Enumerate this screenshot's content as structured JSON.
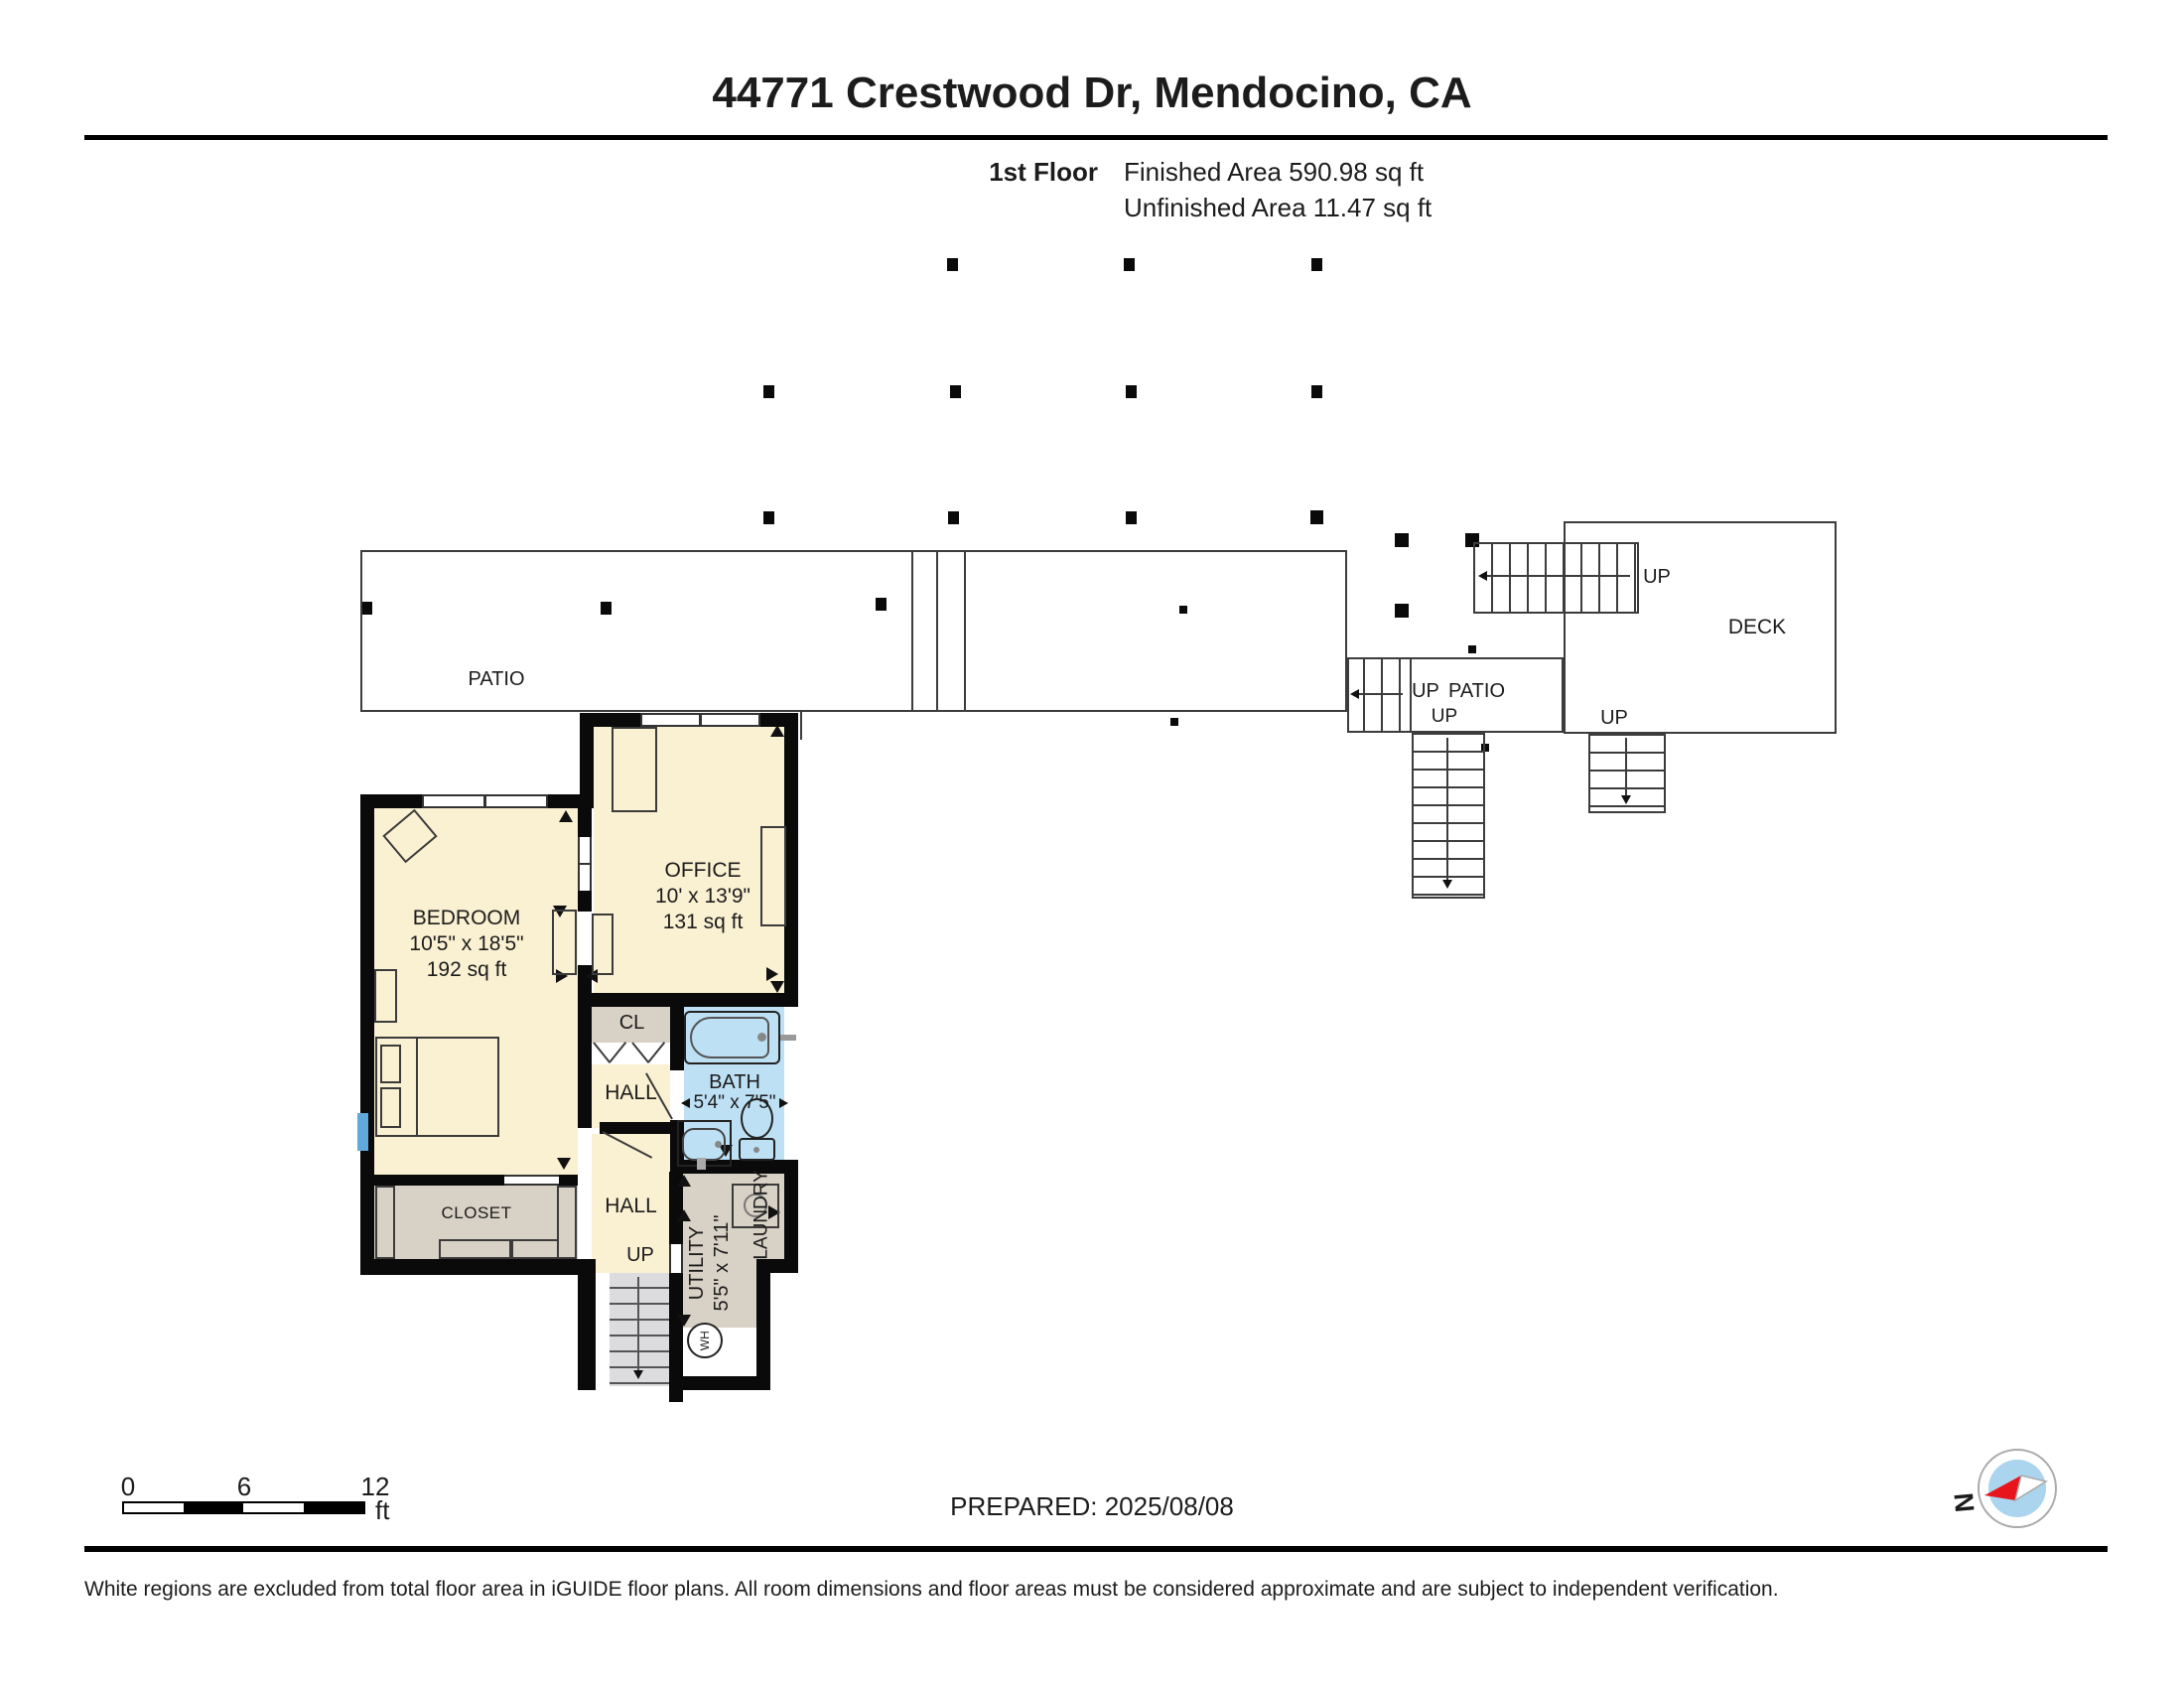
{
  "header": {
    "title": "44771 Crestwood Dr, Mendocino, CA",
    "floor_label": "1st Floor",
    "finished_area": "Finished Area 590.98 sq ft",
    "unfinished_area": "Unfinished Area 11.47 sq ft"
  },
  "outdoor": {
    "patio_label": "PATIO",
    "patio2_label": "PATIO",
    "deck_label": "DECK",
    "up_deck_stairs": "UP",
    "up_deck_down": "UP",
    "up_patio2_stairs": "UP",
    "up_patio2_down": "UP"
  },
  "rooms": {
    "bedroom": {
      "name": "BEDROOM",
      "dims": "10'5\" x 18'5\"",
      "area": "192 sq ft"
    },
    "office": {
      "name": "OFFICE",
      "dims": "10' x 13'9\"",
      "area": "131 sq ft"
    },
    "bath": {
      "name": "BATH",
      "dims": "5'4\" x 7'5\""
    },
    "cl": {
      "name": "CL"
    },
    "hall_upper": {
      "name": "HALL"
    },
    "hall_lower": {
      "name": "HALL"
    },
    "closet": {
      "name": "CLOSET"
    },
    "utility": {
      "name": "UTILITY",
      "dims": "5'5\" x 7'11\""
    },
    "laundry": {
      "name": "LAUNDRY"
    },
    "stairs_up": "UP",
    "water_heater": "WH"
  },
  "footer": {
    "scale": {
      "t0": "0",
      "t6": "6",
      "t12": "12",
      "unit": "ft"
    },
    "prepared": "PREPARED: 2025/08/08",
    "disclaimer": "White regions are excluded from total floor area in iGUIDE floor plans. All room dimensions and floor areas must be considered approximate and are subject to independent verification.",
    "compass_n": "N"
  },
  "colors": {
    "room_fill": "#FAF0D2",
    "closet_fill": "#D8D1C5",
    "bath_fill": "#BEE0F4",
    "stairs_fill": "#DCDCDE",
    "window_blue": "#5FA9DC",
    "wall": "#0A0A0A",
    "compass_inner": "#ABD4EF",
    "compass_red": "#E8161C"
  }
}
